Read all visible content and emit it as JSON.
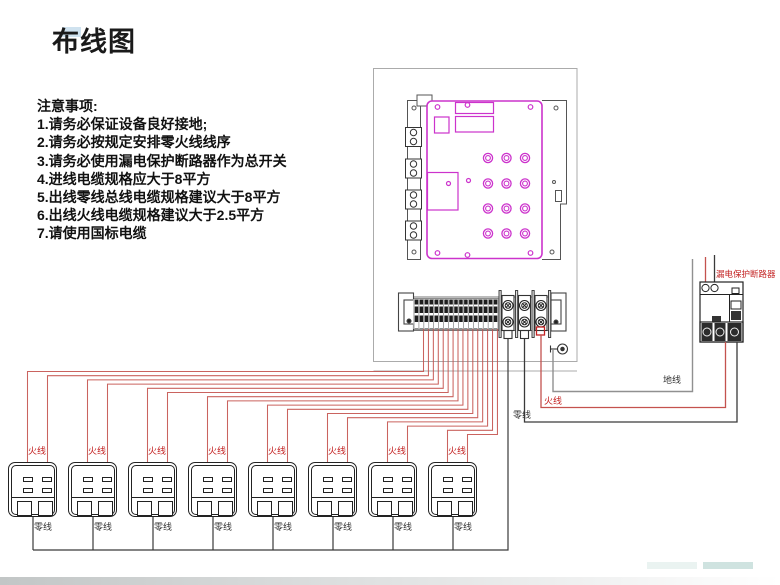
{
  "slide": {
    "title": "布线图"
  },
  "notes": {
    "heading": "注意事项:",
    "items": [
      "1.请务必保证设备良好接地;",
      "2.请务必按规定安排零火线线序",
      "3.请务必使用漏电保护断路器作为总开关",
      "4.进线电缆规格应大于8平方",
      "5.出线零线总线电缆规格建议大于8平方",
      "6.出线火线电缆规格建议大于2.5平方",
      "7.请使用国标电缆"
    ]
  },
  "wiring": {
    "breaker_label": "漏电保护断路器",
    "live_label": "火线",
    "neutral_label": "零线",
    "ground_label": "地线"
  },
  "sockets": {
    "count": 8,
    "live_label": "火线",
    "neutral_label": "零线"
  },
  "colors": {
    "live_wire": "#c4524e",
    "neutral_wire": "#3a3a3a",
    "ground_wire": "#909090",
    "panel_outline": "#cc33cc",
    "label_red": "#c32222",
    "enclosure_gray": "#ababab"
  }
}
